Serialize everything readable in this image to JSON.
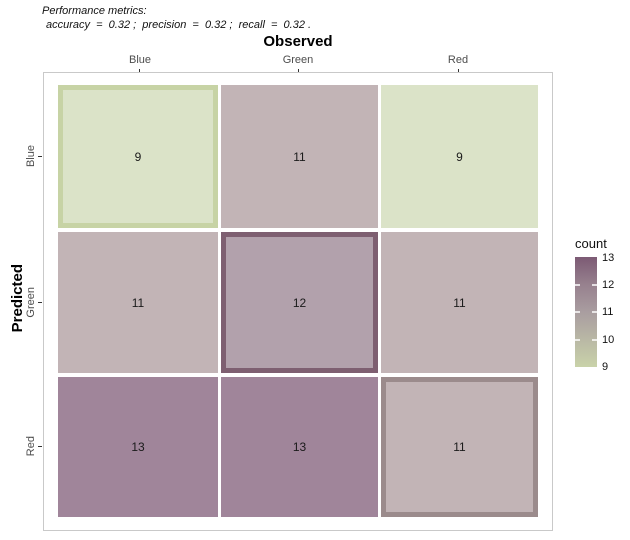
{
  "caption": {
    "line1": "Performance metrics:",
    "line2": "accuracy  =  0.32 ;  precision  =  0.32 ;  recall  =  0.32 ."
  },
  "chart_data": {
    "type": "heatmap",
    "x_axis": {
      "title": "Observed",
      "categories": [
        "Blue",
        "Green",
        "Red"
      ]
    },
    "y_axis": {
      "title": "Predicted",
      "categories": [
        "Blue",
        "Green",
        "Red"
      ]
    },
    "matrix": [
      [
        9,
        11,
        9
      ],
      [
        11,
        12,
        11
      ],
      [
        13,
        13,
        11
      ]
    ],
    "cells": [
      [
        {
          "row": "Blue",
          "col": "Blue",
          "count": 9,
          "fill": "#dbe3c8",
          "border": "#c7d3a5",
          "highlighted": true
        },
        {
          "row": "Blue",
          "col": "Green",
          "count": 11,
          "fill": "#c2b4b6",
          "highlighted": false
        },
        {
          "row": "Blue",
          "col": "Red",
          "count": 9,
          "fill": "#dbe3c8",
          "highlighted": false
        }
      ],
      [
        {
          "row": "Green",
          "col": "Blue",
          "count": 11,
          "fill": "#c2b4b6",
          "highlighted": false
        },
        {
          "row": "Green",
          "col": "Green",
          "count": 12,
          "fill": "#b2a1ac",
          "border": "#7e5f71",
          "highlighted": true
        },
        {
          "row": "Green",
          "col": "Red",
          "count": 11,
          "fill": "#c2b4b6",
          "highlighted": false
        }
      ],
      [
        {
          "row": "Red",
          "col": "Blue",
          "count": 13,
          "fill": "#a0859a",
          "highlighted": false
        },
        {
          "row": "Red",
          "col": "Green",
          "count": 13,
          "fill": "#a0859a",
          "highlighted": false
        },
        {
          "row": "Red",
          "col": "Red",
          "count": 11,
          "fill": "#c2b4b6",
          "border": "#9b8b8c",
          "highlighted": true
        }
      ]
    ],
    "legend": {
      "title": "count",
      "min": 9,
      "max": 13,
      "tick_labels": [
        "13",
        "12",
        "11",
        "10",
        "9"
      ],
      "low_color": "#c9d2a9",
      "high_color": "#7c5a74",
      "gradient_css": "linear-gradient(to bottom, #7c5a74 0%, #97818e 25%, #a99da0 50%, #b9b8a5 75%, #c9d2a9 100%)"
    },
    "grid": false,
    "panel_border_color": "#c9c9c9"
  }
}
